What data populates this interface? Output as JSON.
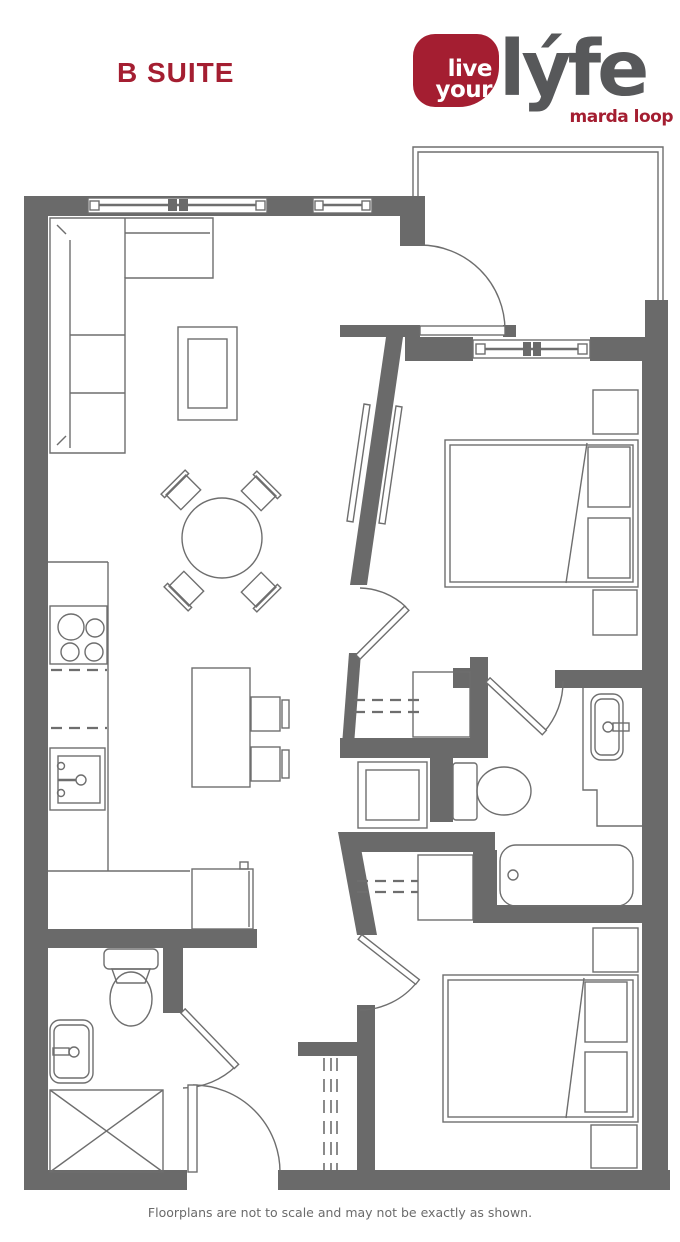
{
  "page": {
    "title": "B SUITE"
  },
  "logo": {
    "tag_line1": "live",
    "tag_line2": "your",
    "word": "lýfe",
    "location": "marda loop"
  },
  "footer": {
    "note": "Floorplans are not to scale and may not be exactly as shown."
  },
  "colors": {
    "accent_red": "#A41E31",
    "logo_gray": "#57585A",
    "wall_gray": "#6A6A6A",
    "line_gray": "#6E6E6E"
  },
  "floorplan": {
    "type": "apartment-suite-floorplan",
    "fixtures": [
      "sectional-sofa",
      "coffee-table",
      "dining-table-with-4-chairs",
      "kitchen-island-with-2-stools",
      "stove-4-burner",
      "kitchen-sink",
      "kitchen-counter",
      "desk-cabinet",
      "balcony",
      "entry-door",
      "sliding-barn-door",
      "bed-queen-1",
      "nightstands-bed-1",
      "bedroom-1-window",
      "closet-shelves-upper",
      "stacked-washer-dryer",
      "closet-shelves-lower",
      "linen-closet-shelves",
      "bathroom-1-toilet",
      "bathroom-1-vanity-sink",
      "bathroom-1-bathtub",
      "bathroom-2-toilet",
      "bathroom-2-vanity-sink",
      "bathroom-2-shower",
      "bed-queen-2",
      "nightstands-bed-2",
      "living-room-windows"
    ]
  }
}
